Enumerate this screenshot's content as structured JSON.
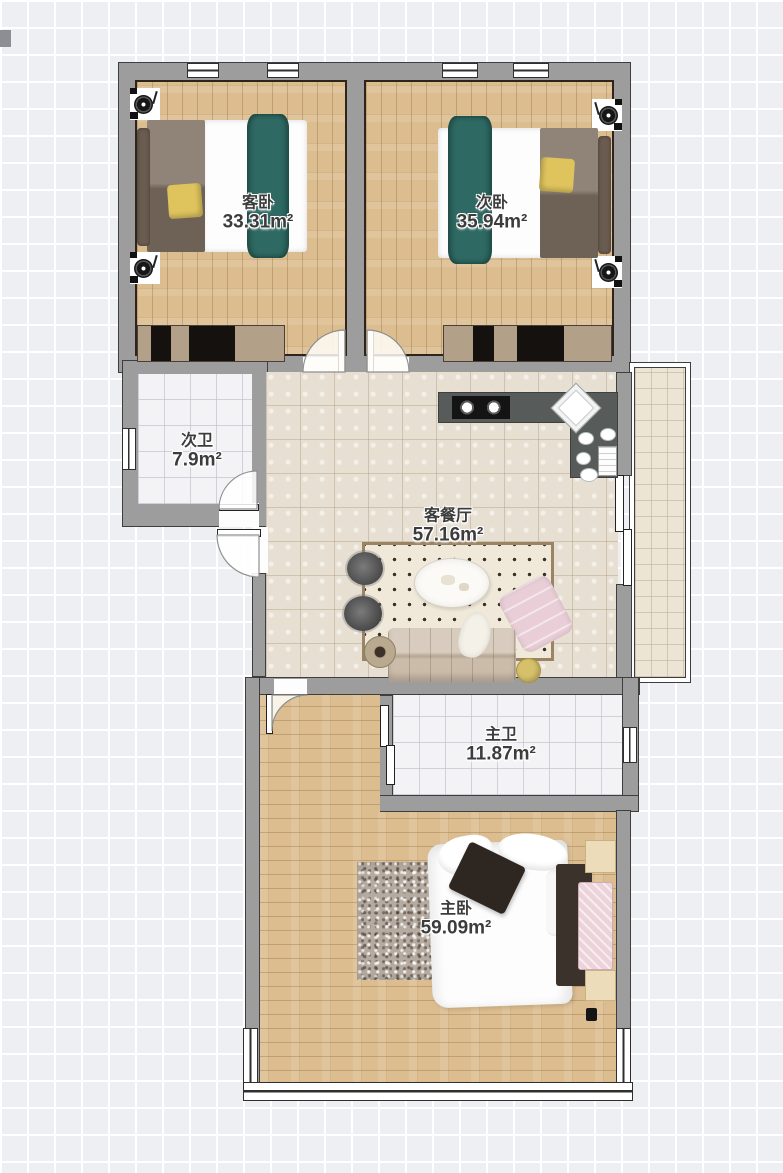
{
  "view": {
    "type": "floor-plan-2d",
    "background": "#edeff2",
    "grid_line_color": "#ffffff"
  },
  "rooms": [
    {
      "name": "客卧",
      "area": "33.31m²"
    },
    {
      "name": "次卧",
      "area": "35.94m²"
    },
    {
      "name": "次卫",
      "area": "7.9m²"
    },
    {
      "name": "客餐厅",
      "area": "57.16m²"
    },
    {
      "name": "主卫",
      "area": "11.87m²"
    },
    {
      "name": "主卧",
      "area": "59.09m²"
    }
  ],
  "colors": {
    "wall": "#9d9d9d",
    "wall_outline": "#3e3e3e",
    "wood_floor": "#dcbd90",
    "living_tile": "#e7dfd2",
    "bath_tile": "#f3f3f6",
    "balcony_tile": "#ece4d4",
    "kitchen_counter": "#575c5b",
    "blanket_teal": "#2e6a63",
    "pillow_yellow": "#dfc45e",
    "chaise_pink": "#e9ced7",
    "sofa_beige": "#cbbba9",
    "label_text": "#3c3c3c"
  },
  "icons": [
    "turntable-icon",
    "bed-icon",
    "wardrobe-icon",
    "stove-icon",
    "sink-icon",
    "sofa-icon",
    "coffee-table-icon",
    "armchair-icon",
    "rug-icon",
    "door-swing-icon",
    "window-icon"
  ]
}
